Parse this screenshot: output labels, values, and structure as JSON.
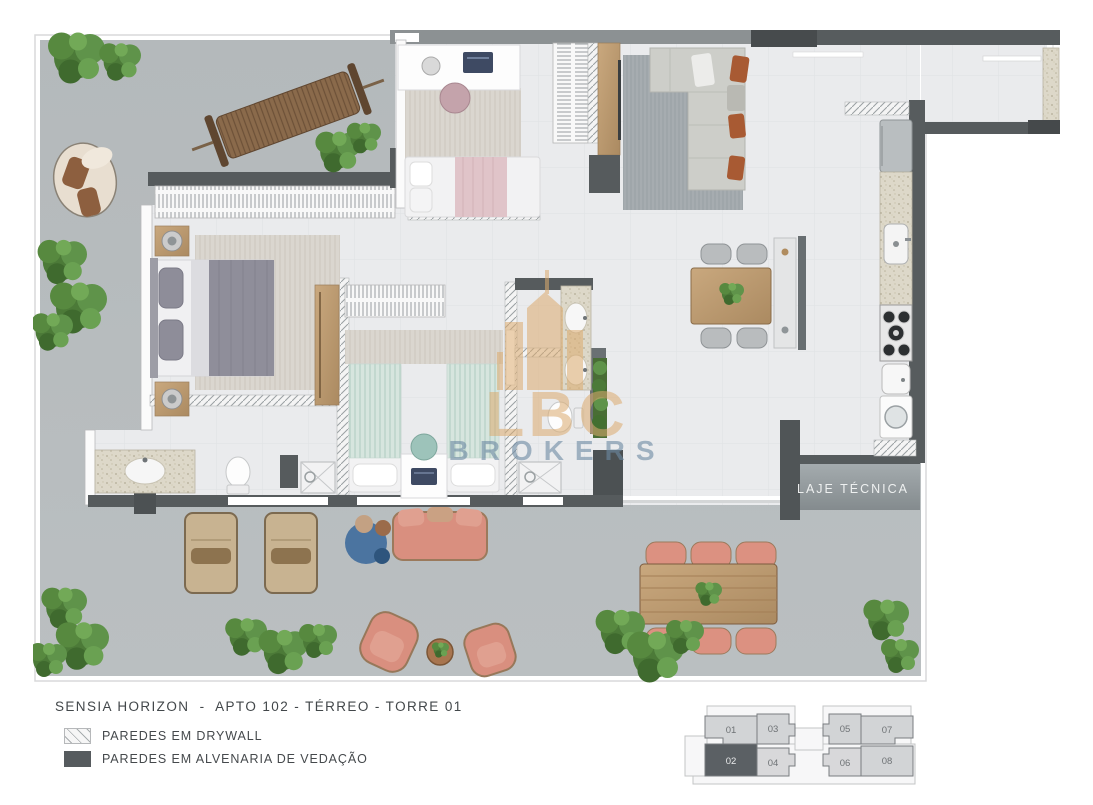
{
  "caption": {
    "title": "SENSIA HORIZON  -  APTO 102 - TÉRREO - TORRE 01"
  },
  "legend": {
    "items": [
      {
        "swatch": "drywall-hatch",
        "label": "PAREDES EM DRYWALL"
      },
      {
        "swatch": "masonry-solid",
        "label": "PAREDES EM ALVENARIA DE VEDAÇÃO"
      }
    ]
  },
  "plan": {
    "laje_label": "LAJE TÉCNICA",
    "watermark": {
      "brand": "LBC",
      "word": "BROKERS"
    }
  },
  "keyplan": {
    "units": [
      {
        "label": "01",
        "highlighted": false
      },
      {
        "label": "03",
        "highlighted": false
      },
      {
        "label": "05",
        "highlighted": false
      },
      {
        "label": "07",
        "highlighted": false
      },
      {
        "label": "02",
        "highlighted": true
      },
      {
        "label": "04",
        "highlighted": false
      },
      {
        "label": "06",
        "highlighted": false
      },
      {
        "label": "08",
        "highlighted": false
      }
    ]
  },
  "colors": {
    "terrace_floor": "#b7bcbe",
    "interior_floor": "#eaebed",
    "masonry_wall": "#575c5e",
    "drywall_hatch": "#9aa0a3",
    "salmon_furniture": "#d98f7f",
    "watermark_gold": "#dcab6e",
    "watermark_blue": "#6d8aa3",
    "keyplan_highlight": "#5b6064"
  }
}
